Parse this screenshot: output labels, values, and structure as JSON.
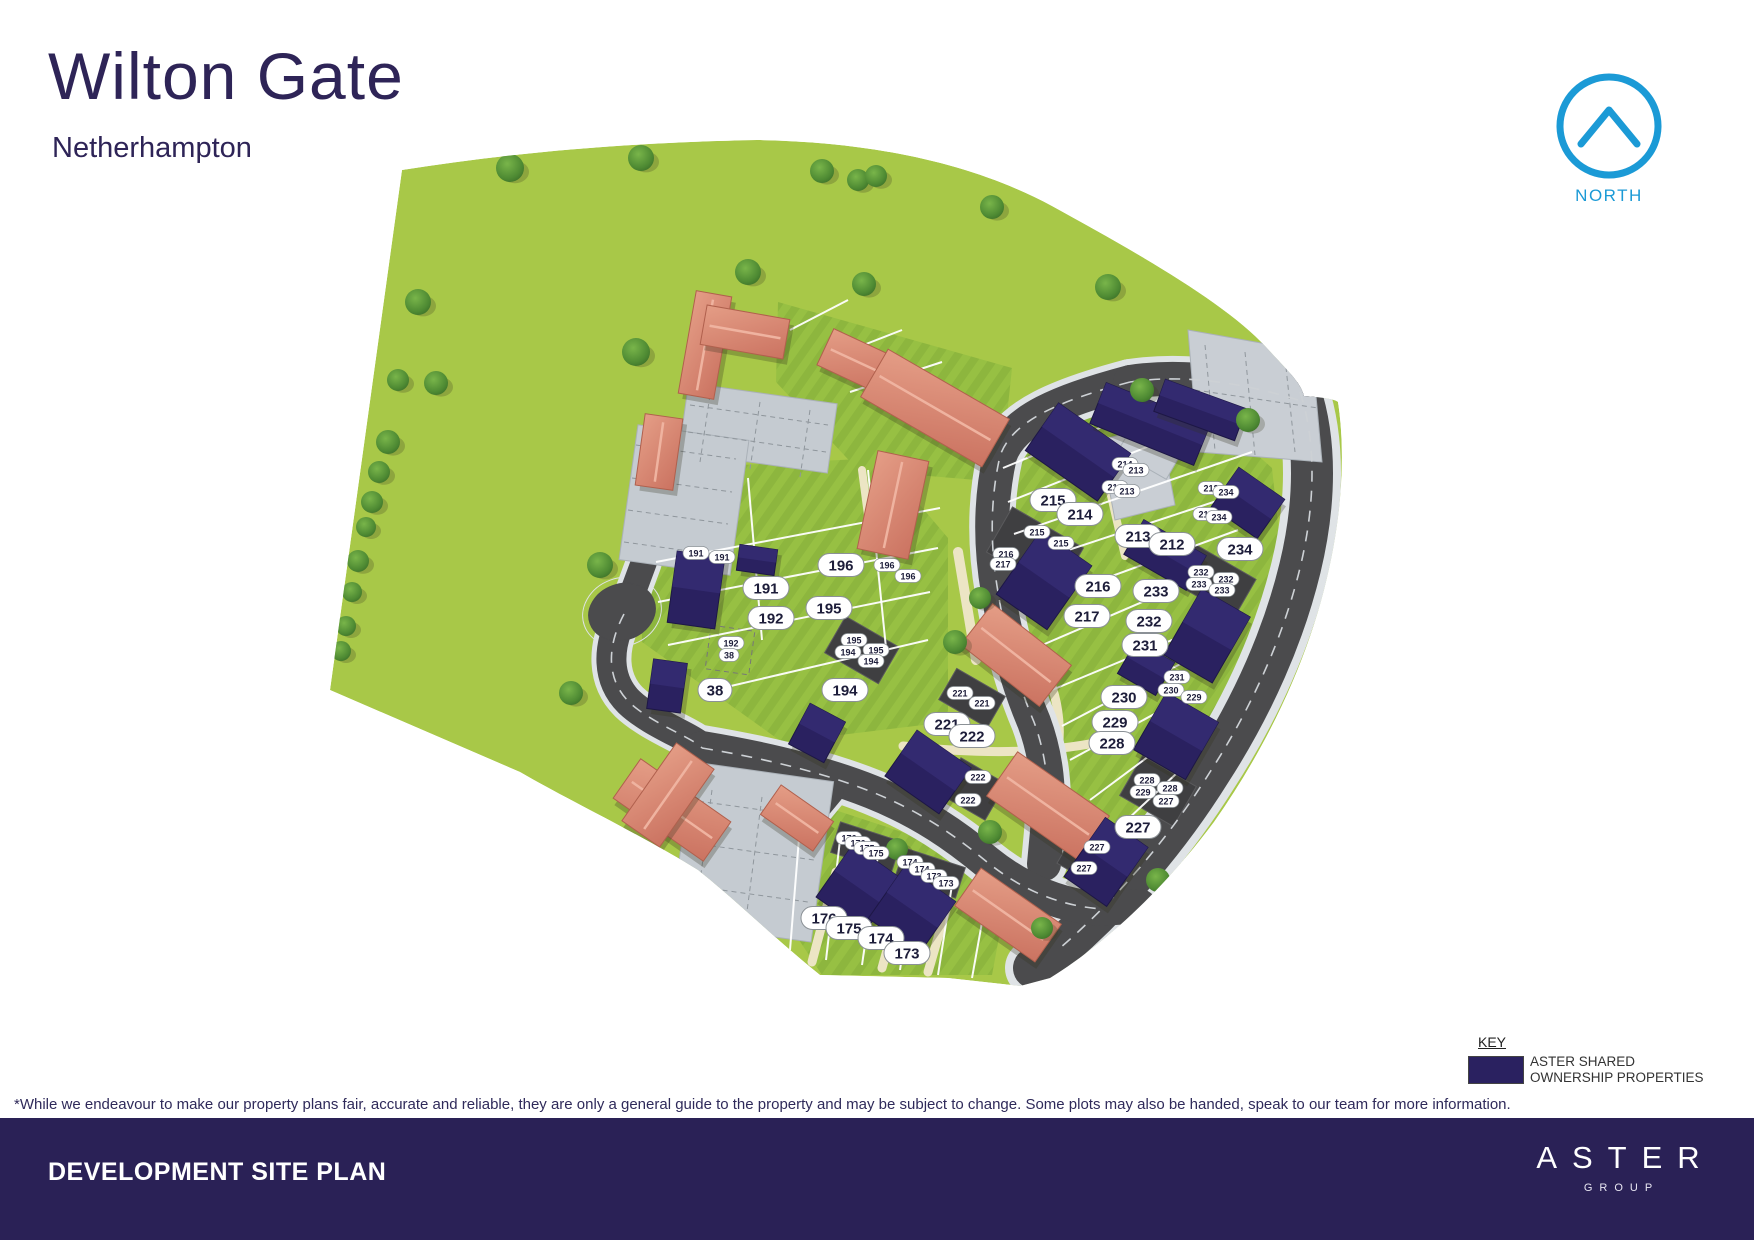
{
  "header": {
    "title": "Wilton Gate",
    "subtitle": "Netherhampton"
  },
  "compass": {
    "label": "NORTH"
  },
  "legend": {
    "title": "KEY",
    "swatch_color": "#2a2160",
    "line1": "ASTER SHARED",
    "line2": "OWNERSHIP PROPERTIES"
  },
  "disclaimer": "*While we endeavour to make our property plans fair, accurate and reliable, they are only a general guide to the property and may be subject to change. Some plots may also be handed, speak to our team for more information.",
  "footer": {
    "title": "DEVELOPMENT SITE PLAN",
    "brand": "ASTER",
    "brand_subtitle": "GROUP"
  },
  "colors": {
    "accent_blue": "#1b9ad6",
    "heading_navy": "#2e2457",
    "footer_navy": "#2a2156",
    "shared_ownership_navy": "#2a2160",
    "private_salmon": "#d98a77",
    "field_green": "#a8c848",
    "plot_green": "#8db63e",
    "road_gray": "#4b4b4d",
    "parking_gray": "#c5cbd1",
    "pavement_gray": "#dfe3e6",
    "path_cream": "#ece5c4"
  },
  "site_plan": {
    "plot_labels_large": [
      {
        "id": "191",
        "x": 766,
        "y": 588
      },
      {
        "id": "192",
        "x": 771,
        "y": 618
      },
      {
        "id": "38",
        "x": 715,
        "y": 690
      },
      {
        "id": "196",
        "x": 841,
        "y": 565
      },
      {
        "id": "195",
        "x": 829,
        "y": 608
      },
      {
        "id": "194",
        "x": 845,
        "y": 690
      },
      {
        "id": "215",
        "x": 1053,
        "y": 500
      },
      {
        "id": "214",
        "x": 1080,
        "y": 514
      },
      {
        "id": "213",
        "x": 1138,
        "y": 536
      },
      {
        "id": "212",
        "x": 1172,
        "y": 544
      },
      {
        "id": "234",
        "x": 1240,
        "y": 549
      },
      {
        "id": "216",
        "x": 1098,
        "y": 586
      },
      {
        "id": "233",
        "x": 1156,
        "y": 591
      },
      {
        "id": "217",
        "x": 1087,
        "y": 616
      },
      {
        "id": "232",
        "x": 1149,
        "y": 621
      },
      {
        "id": "231",
        "x": 1145,
        "y": 645
      },
      {
        "id": "230",
        "x": 1124,
        "y": 697
      },
      {
        "id": "229",
        "x": 1115,
        "y": 722
      },
      {
        "id": "228",
        "x": 1112,
        "y": 743
      },
      {
        "id": "221",
        "x": 947,
        "y": 724
      },
      {
        "id": "222",
        "x": 972,
        "y": 736
      },
      {
        "id": "227",
        "x": 1138,
        "y": 827
      },
      {
        "id": "176",
        "x": 824,
        "y": 918
      },
      {
        "id": "175",
        "x": 849,
        "y": 928
      },
      {
        "id": "174",
        "x": 881,
        "y": 938
      },
      {
        "id": "173",
        "x": 907,
        "y": 953
      }
    ],
    "plot_labels_small": [
      {
        "id": "191",
        "x": 696,
        "y": 553
      },
      {
        "id": "191",
        "x": 722,
        "y": 557
      },
      {
        "id": "192",
        "x": 731,
        "y": 643
      },
      {
        "id": "38",
        "x": 729,
        "y": 655
      },
      {
        "id": "196",
        "x": 887,
        "y": 565
      },
      {
        "id": "196",
        "x": 908,
        "y": 576
      },
      {
        "id": "195",
        "x": 854,
        "y": 640
      },
      {
        "id": "195",
        "x": 876,
        "y": 650
      },
      {
        "id": "194",
        "x": 848,
        "y": 652
      },
      {
        "id": "194",
        "x": 871,
        "y": 661
      },
      {
        "id": "215",
        "x": 1037,
        "y": 532
      },
      {
        "id": "215",
        "x": 1061,
        "y": 543
      },
      {
        "id": "216",
        "x": 1006,
        "y": 554
      },
      {
        "id": "217",
        "x": 1003,
        "y": 564
      },
      {
        "id": "214",
        "x": 1125,
        "y": 464
      },
      {
        "id": "213",
        "x": 1136,
        "y": 470
      },
      {
        "id": "214",
        "x": 1115,
        "y": 487
      },
      {
        "id": "213",
        "x": 1127,
        "y": 491
      },
      {
        "id": "212",
        "x": 1211,
        "y": 488
      },
      {
        "id": "234",
        "x": 1226,
        "y": 492
      },
      {
        "id": "212",
        "x": 1206,
        "y": 514
      },
      {
        "id": "234",
        "x": 1219,
        "y": 517
      },
      {
        "id": "232",
        "x": 1201,
        "y": 572
      },
      {
        "id": "232",
        "x": 1226,
        "y": 579
      },
      {
        "id": "233",
        "x": 1199,
        "y": 584
      },
      {
        "id": "233",
        "x": 1222,
        "y": 590
      },
      {
        "id": "231",
        "x": 1177,
        "y": 677
      },
      {
        "id": "230",
        "x": 1171,
        "y": 690
      },
      {
        "id": "229",
        "x": 1194,
        "y": 697
      },
      {
        "id": "221",
        "x": 960,
        "y": 693
      },
      {
        "id": "221",
        "x": 982,
        "y": 703
      },
      {
        "id": "222",
        "x": 978,
        "y": 777
      },
      {
        "id": "222",
        "x": 968,
        "y": 800
      },
      {
        "id": "228",
        "x": 1147,
        "y": 780
      },
      {
        "id": "229",
        "x": 1143,
        "y": 792
      },
      {
        "id": "228",
        "x": 1170,
        "y": 788
      },
      {
        "id": "227",
        "x": 1166,
        "y": 801
      },
      {
        "id": "227",
        "x": 1097,
        "y": 847
      },
      {
        "id": "227",
        "x": 1084,
        "y": 868
      },
      {
        "id": "176",
        "x": 849,
        "y": 838
      },
      {
        "id": "176",
        "x": 858,
        "y": 843
      },
      {
        "id": "175",
        "x": 867,
        "y": 848
      },
      {
        "id": "175",
        "x": 876,
        "y": 853
      },
      {
        "id": "174",
        "x": 910,
        "y": 862
      },
      {
        "id": "174",
        "x": 922,
        "y": 869
      },
      {
        "id": "173",
        "x": 934,
        "y": 876
      },
      {
        "id": "173",
        "x": 946,
        "y": 883
      }
    ]
  }
}
